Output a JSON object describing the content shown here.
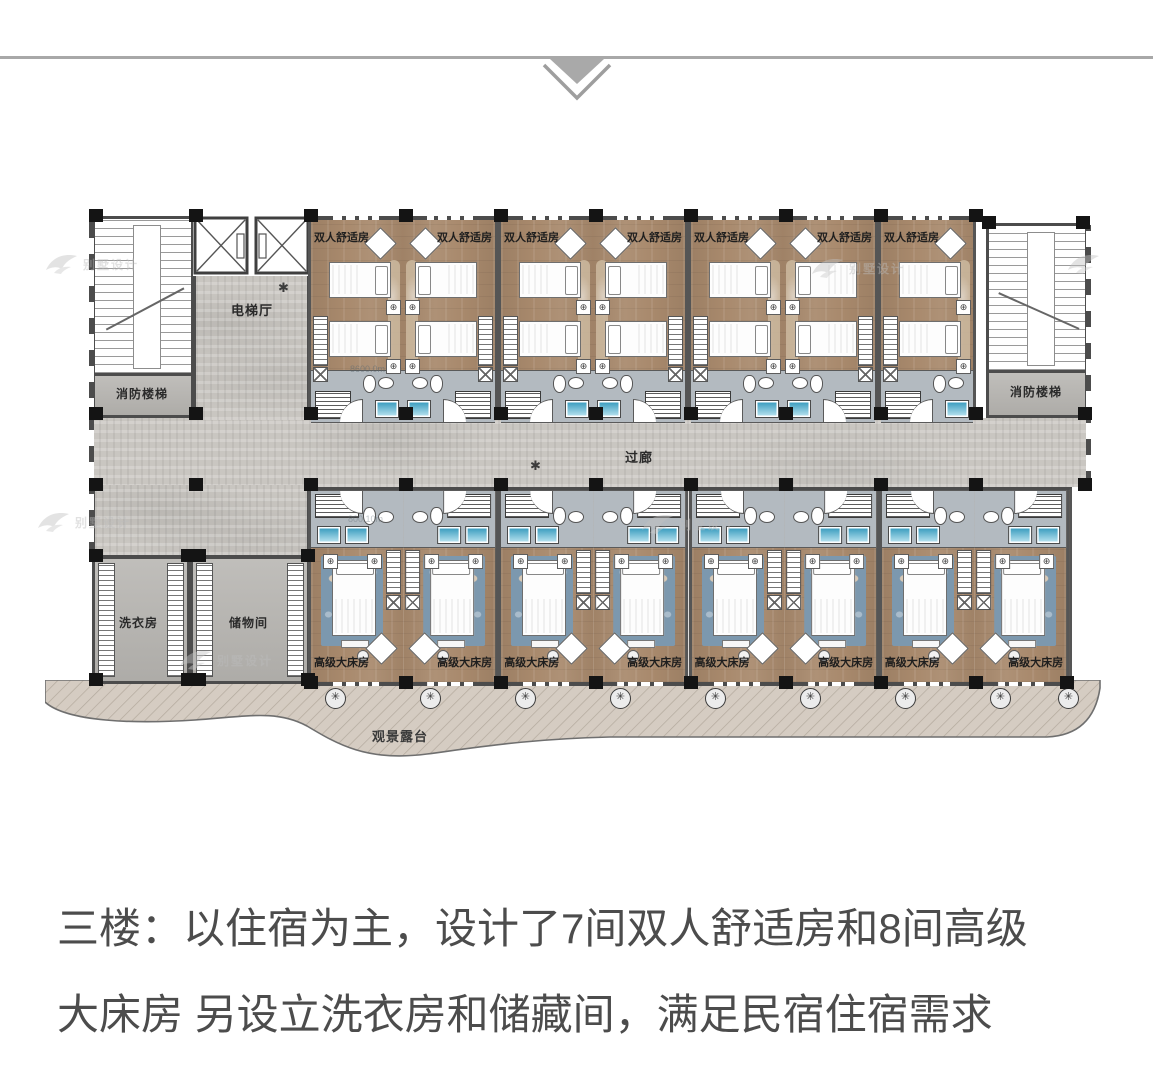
{
  "divider": {
    "icon": "chevron-down-icon"
  },
  "floor_plan": {
    "labels": {
      "corridor": "过廊",
      "elevator_hall": "电梯厅",
      "fire_stairs_left": "消防楼梯",
      "fire_stairs_right": "消防楼梯",
      "laundry": "洗衣房",
      "storage": "储物间",
      "terrace": "观景露台"
    },
    "double_rooms": [
      {
        "label": "双人舒适房"
      },
      {
        "label": "双人舒适房"
      },
      {
        "label": "双人舒适房"
      },
      {
        "label": "双人舒适房"
      },
      {
        "label": "双人舒适房"
      },
      {
        "label": "双人舒适房"
      },
      {
        "label": "双人舒适房"
      }
    ],
    "king_rooms": [
      {
        "label": "高级大床房"
      },
      {
        "label": "高级大床房"
      },
      {
        "label": "高级大床房"
      },
      {
        "label": "高级大床房"
      },
      {
        "label": "高级大床房"
      },
      {
        "label": "高级大床房"
      },
      {
        "label": "高级大床房"
      },
      {
        "label": "高级大床房"
      }
    ],
    "dimension_notes": [
      "8600.0m",
      "800.10m"
    ],
    "watermark_text": "别墅设计",
    "colors": {
      "wood_floor": "#a8896c",
      "corridor_concrete": "#c9c6c1",
      "service_gray": "#b7b5b1",
      "rug_blue": "#7c98ae",
      "shower_teal": "#2f96bb",
      "wall": "#4c4c4c",
      "terrace_wood": "#d5ccc2",
      "divider_gray": "#a8a8a8"
    }
  },
  "caption": {
    "lines": [
      "三楼：以住宿为主，设计了7间双人舒适房和8间高级",
      "大床房 另设立洗衣房和储藏间，满足民宿住宿需求"
    ]
  }
}
